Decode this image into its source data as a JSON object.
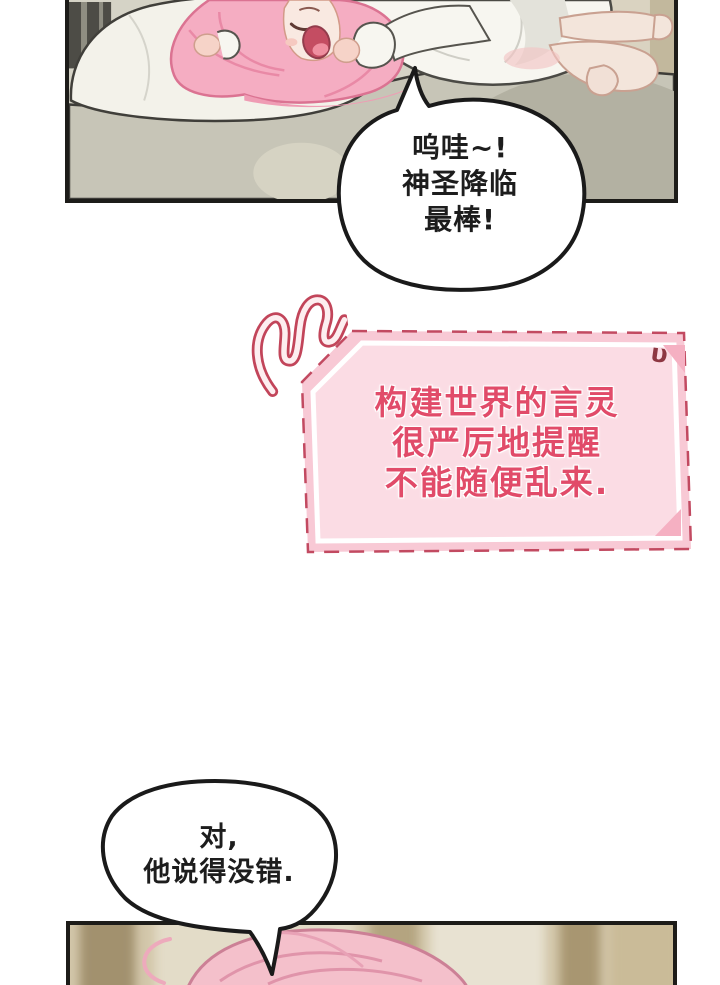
{
  "speech_top": {
    "lines": [
      "呜哇~!",
      "神圣降临",
      "最棒!"
    ]
  },
  "system_box": {
    "lines": [
      "构建世界的言灵",
      "很严厉地提醒",
      "不能随便乱来."
    ],
    "corner_mark": "υ"
  },
  "speech_bottom": {
    "lines": [
      "对,",
      "他说得没错."
    ]
  },
  "scene": {
    "panel_top": "pink-haired girl in white pajamas lying sprawled on a bed, cheering",
    "panel_bottom": "blurred close-up of the top of the pink-haired girl's head"
  },
  "colors": {
    "page_bg": "#ffffff",
    "panel_border": "#1d1c19",
    "bubble_fill": "#ffffff",
    "bubble_border": "#1a1a1a",
    "bubble_text": "#1d1d1d",
    "box_band": "#f8c9d5",
    "box_inner": "#fbdce4",
    "box_dash_border": "#c24a61",
    "box_fold": "#f5b0c2",
    "box_text": "#e14b69",
    "hair_pink": "#f5adc2",
    "bed_beige": "#d5d3c6"
  }
}
